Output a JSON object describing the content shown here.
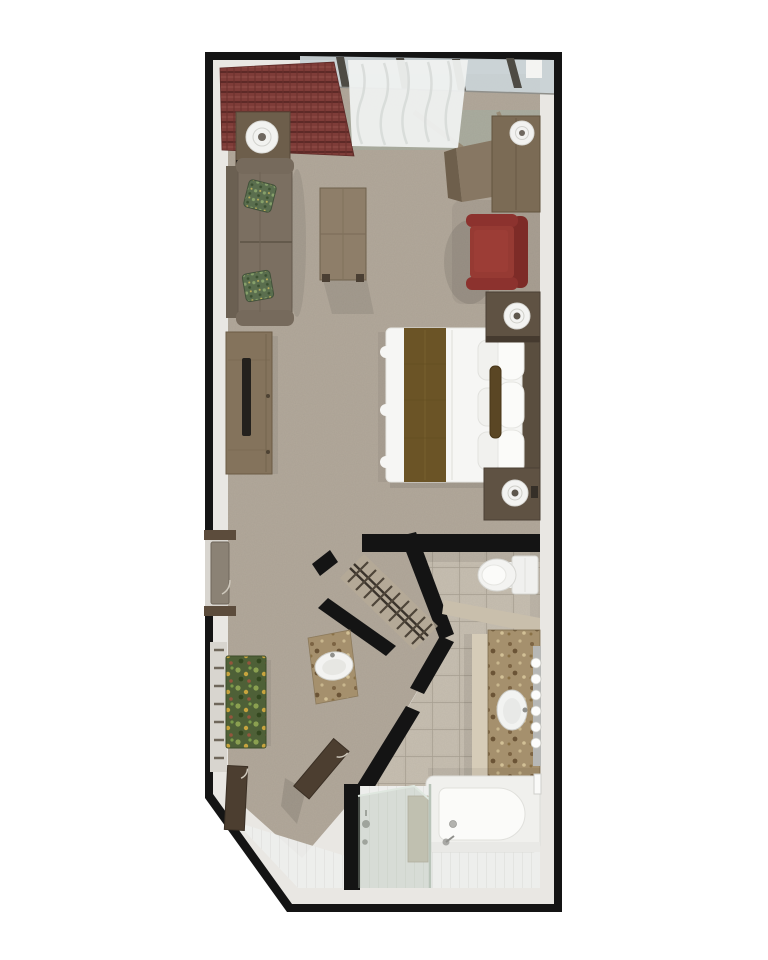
{
  "meta": {
    "title": "Suite Floor Plan",
    "view": "3d-top-down-render",
    "canvas": {
      "width": 768,
      "height": 960
    }
  },
  "palette": {
    "background": "#ffffff",
    "wall": "#141414",
    "wall_face": "#e9e7e3",
    "carpet": "#b2a89a",
    "entry_tile": "#a9ac9e",
    "bath_tile": "#c5bdaf",
    "tile_grout": "#a79f91",
    "plank": "#edeeec",
    "plank_line": "#d9dad6",
    "window_glass": "#c9d2d5",
    "shower_glass": "#a9baa9",
    "drape_red": "#7e3c38",
    "sheer_white": "#eff1f0",
    "sofa_taupe": "#7b6f61",
    "pillow_green": "#5a6e4e",
    "wood_light": "#8e7e69",
    "wood_mid": "#7b6b55",
    "wood_dark": "#5f5243",
    "door_wood": "#4c3e30",
    "entry_door_gray": "#8b8275",
    "chair_red": "#963a33",
    "chair_red_dark": "#7d2b27",
    "bed_white": "#f6f6f4",
    "pillow_white": "#fbfbf9",
    "runner_brown": "#6b5426",
    "bolster_brown": "#5a4624",
    "headboard_brown": "#5a4e3f",
    "granite": "#a5906d",
    "granite_edge": "#d6ccb8",
    "rug_green": "#4e6037",
    "fixture_white": "#f3f3f1",
    "lamp_white": "#f2f2f0",
    "tv_black": "#24211d",
    "bench_tan": "#cbc4b3",
    "tan_wall": "#c9bfac",
    "mirror_gray": "#b7b8b6"
  },
  "scene": {
    "rooms": [
      {
        "name": "living-sleeping-area",
        "floor": "carpet"
      },
      {
        "name": "dressing-hall",
        "floor": "carpet"
      },
      {
        "name": "walk-in-closet",
        "floor": "carpet",
        "hanger_count": 9,
        "rods": 2
      },
      {
        "name": "bathroom",
        "floor": "stone-tile-and-white-plank"
      }
    ],
    "furniture": [
      {
        "name": "window-wall-glass",
        "color": "window_glass"
      },
      {
        "name": "red-plaid-drapery",
        "color": "drape_red"
      },
      {
        "name": "sheer-curtain",
        "color": "sheer_white"
      },
      {
        "name": "side-table-with-lamp",
        "color": "wood_mid"
      },
      {
        "name": "sofa",
        "color": "sofa_taupe",
        "accent_pillows": 2
      },
      {
        "name": "coffee-table",
        "color": "wood_light"
      },
      {
        "name": "media-console-with-tv",
        "color": "wood_light"
      },
      {
        "name": "desk-with-chair-and-lamp",
        "color": "wood_mid"
      },
      {
        "name": "red-armchair",
        "color": "chair_red"
      },
      {
        "name": "bed-with-runner-and-bolster",
        "color": "bed_white",
        "pillow_rows": 3
      },
      {
        "name": "nightstands-with-lamps",
        "count": 2,
        "color": "wood_dark"
      },
      {
        "name": "entry-door",
        "color": "entry_door_gray"
      },
      {
        "name": "towel-ladder",
        "rungs": 7
      },
      {
        "name": "green-floral-rug",
        "color": "rug_green"
      },
      {
        "name": "vanity-sink-nook",
        "color": "granite"
      },
      {
        "name": "open-doors",
        "count": 2,
        "color": "door_wood"
      },
      {
        "name": "toilet",
        "color": "fixture_white"
      },
      {
        "name": "granite-vanity-with-sink",
        "color": "granite",
        "vanity_bulbs": 6
      },
      {
        "name": "bathtub-with-faucet",
        "color": "fixture_white"
      },
      {
        "name": "towel-bar",
        "color": "fixture_white"
      },
      {
        "name": "glass-shower-with-bench",
        "color": "shower_glass"
      }
    ]
  }
}
